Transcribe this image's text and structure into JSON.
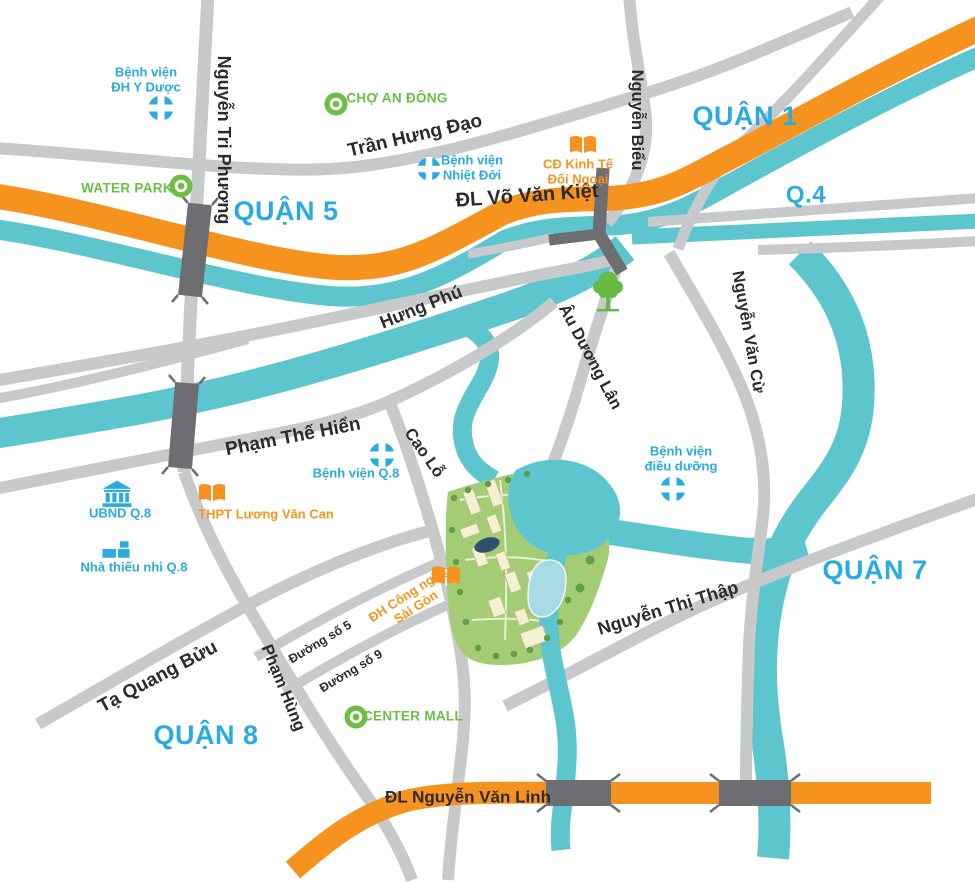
{
  "map_title": "District location map - Ho Chi Minh City",
  "colors": {
    "district_label": "#29ABE2",
    "road_fill": "#C8C9CB",
    "highway_fill": "#F6921E",
    "river_fill": "#5CC5CE",
    "bridge_fill": "#6D6E71",
    "poi_blue": "#29ABE2",
    "poi_green": "#6CBE45",
    "poi_orange": "#F7941D",
    "road_label": "#2B2B2B",
    "site_green": "#A3CC74"
  },
  "icons": {
    "hospital": "hospital-cross-circle",
    "market": "green-ring-dot",
    "school": "orange-open-book",
    "government": "bank-building",
    "youth_house": "building-blocks",
    "park": "tree"
  },
  "districts": {
    "q1": "QUẬN 1",
    "q4": "Q.4",
    "q5": "QUẬN 5",
    "q7": "QUẬN 7",
    "q8": "QUẬN 8"
  },
  "roads": {
    "tran_hung_dao": "Trần Hưng Đạo",
    "vo_van_kiet": "ĐL Võ Văn Kiệt",
    "nguyen_tri_phuong": "Nguyễn Tri Phương",
    "nguyen_bieu": "Nguyễn Biểu",
    "nguyen_van_cu": "Nguyễn Văn Cừ",
    "hung_phu": "Hưng Phú",
    "au_duong_lan": "Âu Dương Lân",
    "pham_the_hien": "Phạm Thế Hiển",
    "cao_lo": "Cao Lỗ",
    "ta_quang_buu": "Tạ Quang Bửu",
    "pham_hung": "Phạm Hùng",
    "duong_so_5": "Đường số 5",
    "duong_so_9": "Đường số 9",
    "nguyen_thi_thap": "Nguyễn Thị Thập",
    "nguyen_van_linh": "ĐL Nguyễn Văn Linh"
  },
  "pois": {
    "bv_dh_y_duoc": {
      "l1": "Bệnh viện",
      "l2": "ĐH Y Dược"
    },
    "cho_an_dong": {
      "label": "CHỢ AN ĐÔNG"
    },
    "water_park": {
      "label": "WATER PARK"
    },
    "bv_nhiet_doi": {
      "l1": "Bệnh viện",
      "l2": "Nhiệt Đới"
    },
    "cd_kinh_te_doi_ngoai": {
      "l1": "CĐ Kinh Tế",
      "l2": "Đối Ngoại"
    },
    "bv_q8": {
      "label": "Bệnh viện Q.8"
    },
    "ubnd_q8": {
      "label": "UBND Q.8"
    },
    "thpt_luong_van_can": {
      "label": "THPT Lương Văn Can"
    },
    "nha_thieu_nhi_q8": {
      "label": "Nhà thiếu nhi Q.8"
    },
    "bv_dieu_duong": {
      "l1": "Bệnh viện",
      "l2": "điều dưỡng"
    },
    "dh_cong_nghe_sai_gon": {
      "l1": "ĐH Công nghệ",
      "l2": "Sài Gòn"
    },
    "center_mall": {
      "label": "CENTER MALL"
    }
  }
}
